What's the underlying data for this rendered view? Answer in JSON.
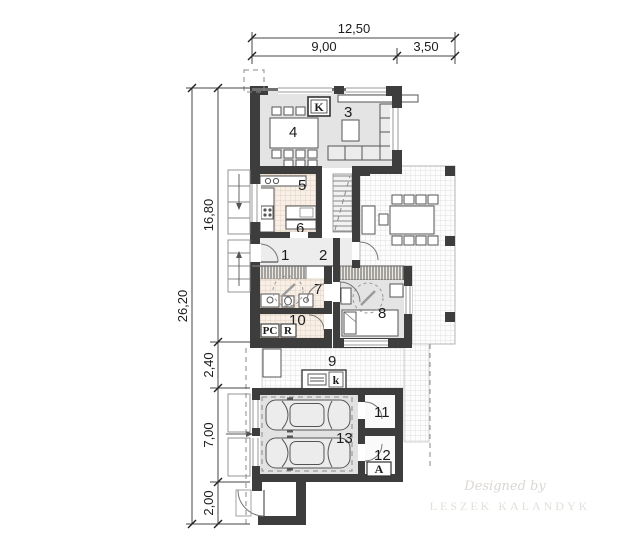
{
  "plan": {
    "dim_top": {
      "total": "12,50",
      "left": "9,00",
      "right": "3,50"
    },
    "dim_left": {
      "total": "26,20",
      "seg1": "16,80",
      "seg2": "2,40",
      "seg3": "7,00",
      "seg4": "2,00"
    },
    "room_labels": {
      "r1": "1",
      "r2": "2",
      "r3": "3",
      "r4": "4",
      "r5": "5",
      "r6": "6",
      "r7": "7",
      "r8": "8",
      "r9": "9",
      "r10": "10",
      "r11": "11",
      "r12": "12",
      "r13": "13"
    },
    "markers": {
      "fireplace": "K",
      "grill": "k",
      "pc": "PC",
      "r": "R",
      "a": "A"
    },
    "watermark": {
      "line1": "Designed by",
      "line2": "LESZEK KALANDYK"
    },
    "colors": {
      "wall": "#3d3d3d",
      "room_fill": "#e4e4e4",
      "hatch_fill": "#f8f0e7",
      "terrace_line": "#d8d8d8"
    }
  }
}
